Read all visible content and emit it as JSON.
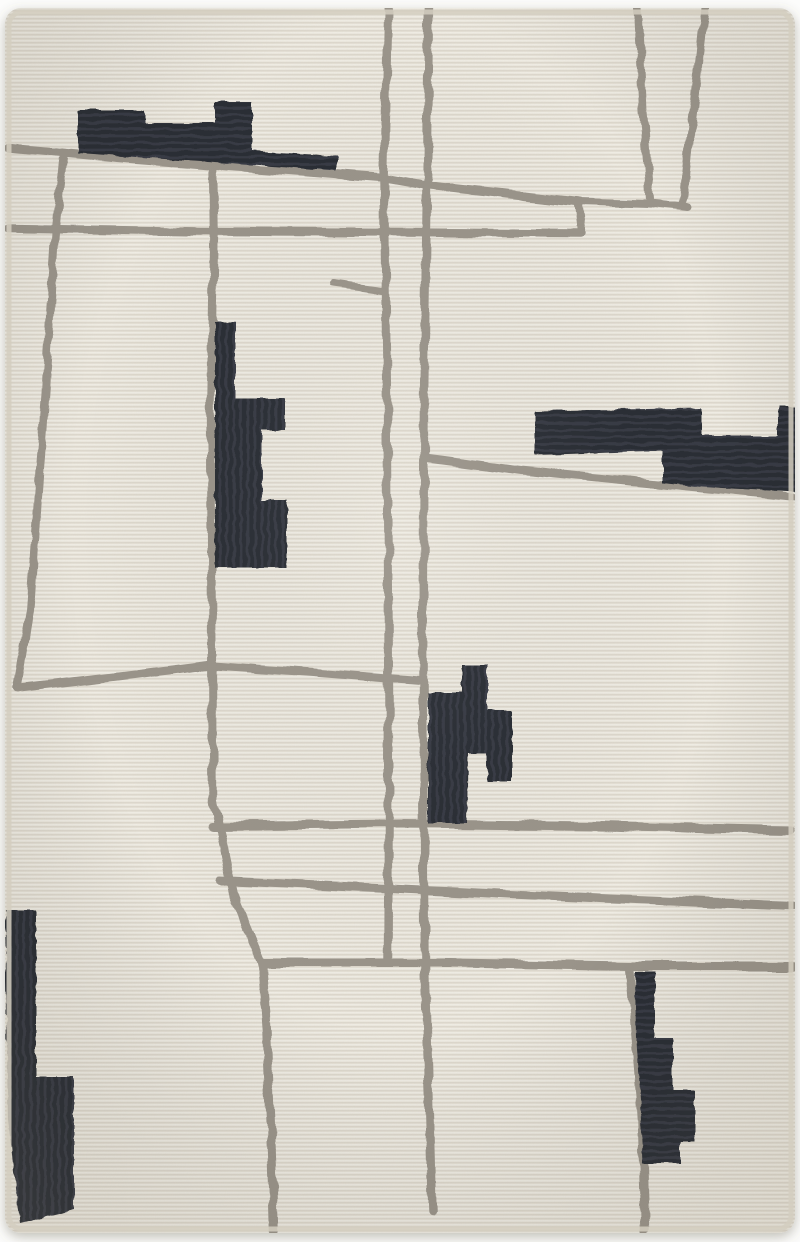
{
  "image": {
    "subject": "Abstract modern area rug, ivory wool with taupe gray abstract map lines and dark charcoal geometric tetris-like blocks",
    "canvas": {
      "width": 800,
      "height": 1242
    },
    "colors": {
      "background": "#fcfcfb",
      "rug_base": "#e9e5da",
      "weave_light": "rgba(255,255,255,0.30)",
      "weave_dark": "rgba(120,110,92,0.13)",
      "rug_edge": "#d4cec0",
      "line_gray": "#9a948a",
      "block_black": "#2b2d34",
      "block_rib": "#383b44",
      "shadow": "rgba(95,88,72,0.38)",
      "vignette": "rgba(125,115,94,0.14)"
    },
    "rug": {
      "x": 5,
      "y": 8,
      "width": 790,
      "height": 1225,
      "corner_radius": 16,
      "binding_inset": 4,
      "binding_width": 5
    },
    "lines": [
      {
        "name": "line-top-diagonal",
        "width": 8.5,
        "points": [
          [
            10,
            148
          ],
          [
            120,
            158
          ],
          [
            240,
            167
          ],
          [
            383,
            178
          ],
          [
            428,
            186
          ],
          [
            577,
            202
          ]
        ]
      },
      {
        "name": "line-top-diagonal-right",
        "width": 8,
        "points": [
          [
            577,
            202
          ],
          [
            650,
            204
          ],
          [
            690,
            208
          ]
        ]
      },
      {
        "name": "line-step-drop",
        "width": 8,
        "points": [
          [
            577,
            202
          ],
          [
            581,
            232
          ]
        ]
      },
      {
        "name": "line-upper-horizontal",
        "width": 8.5,
        "points": [
          [
            8,
            228
          ],
          [
            200,
            231
          ],
          [
            400,
            232
          ],
          [
            581,
            233
          ]
        ]
      },
      {
        "name": "line-left-vertical",
        "width": 8,
        "points": [
          [
            64,
            153
          ],
          [
            55,
            232
          ],
          [
            45,
            400
          ],
          [
            30,
            610
          ],
          [
            17,
            688
          ]
        ]
      },
      {
        "name": "line-mid-left-horizontal",
        "width": 8.5,
        "points": [
          [
            17,
            688
          ],
          [
            120,
            676
          ],
          [
            210,
            665
          ],
          [
            310,
            672
          ],
          [
            423,
            681
          ]
        ]
      },
      {
        "name": "line-center-vertical",
        "width": 8.5,
        "points": [
          [
            213,
            164
          ],
          [
            214,
            232
          ],
          [
            211,
            400
          ],
          [
            212,
            600
          ],
          [
            213,
            797
          ],
          [
            233,
            893
          ],
          [
            262,
            963
          ]
        ]
      },
      {
        "name": "line-center-vertical-low",
        "width": 8.5,
        "points": [
          [
            262,
            963
          ],
          [
            267,
            1033
          ],
          [
            271,
            1130
          ],
          [
            274,
            1230
          ]
        ]
      },
      {
        "name": "line-road-vertical-a",
        "width": 8.5,
        "points": [
          [
            388,
            0
          ],
          [
            384,
            180
          ],
          [
            387,
            400
          ],
          [
            389,
            700
          ],
          [
            388,
            963
          ]
        ]
      },
      {
        "name": "line-road-vertical-b",
        "width": 8.5,
        "points": [
          [
            429,
            0
          ],
          [
            427,
            186
          ],
          [
            424,
            400
          ],
          [
            423,
            683
          ],
          [
            425,
            967
          ],
          [
            429,
            1100
          ],
          [
            432,
            1213
          ]
        ]
      },
      {
        "name": "line-funnel-left",
        "width": 8,
        "points": [
          [
            638,
            8
          ],
          [
            643,
            110
          ],
          [
            650,
            200
          ]
        ]
      },
      {
        "name": "line-funnel-right",
        "width": 8,
        "points": [
          [
            705,
            8
          ],
          [
            688,
            150
          ],
          [
            683,
            206
          ]
        ]
      },
      {
        "name": "line-short-stub",
        "width": 7,
        "points": [
          [
            333,
            284
          ],
          [
            385,
            291
          ]
        ]
      },
      {
        "name": "line-right-diagonal",
        "width": 8,
        "points": [
          [
            428,
            458
          ],
          [
            520,
            470
          ],
          [
            653,
            483
          ],
          [
            797,
            497
          ]
        ]
      },
      {
        "name": "line-lower-horizontal-1",
        "width": 9,
        "points": [
          [
            212,
            826
          ],
          [
            400,
            824
          ],
          [
            600,
            826
          ],
          [
            790,
            830
          ]
        ]
      },
      {
        "name": "line-lower-horizontal-2",
        "width": 9,
        "points": [
          [
            220,
            881
          ],
          [
            400,
            889
          ],
          [
            600,
            898
          ],
          [
            792,
            906
          ]
        ]
      },
      {
        "name": "line-lower-horizontal-3",
        "width": 9,
        "points": [
          [
            262,
            963
          ],
          [
            450,
            963
          ],
          [
            630,
            966
          ],
          [
            793,
            966
          ]
        ]
      },
      {
        "name": "line-bottom-vertical",
        "width": 8.5,
        "points": [
          [
            630,
            967
          ],
          [
            636,
            1040
          ],
          [
            642,
            1120
          ],
          [
            645,
            1230
          ]
        ]
      }
    ],
    "blocks": [
      {
        "name": "block-top-left-skyline",
        "ribs": "h",
        "points": [
          [
            78,
            110
          ],
          [
            145,
            110
          ],
          [
            145,
            123
          ],
          [
            215,
            123
          ],
          [
            215,
            102
          ],
          [
            252,
            102
          ],
          [
            252,
            151
          ],
          [
            337,
            156
          ],
          [
            337,
            171
          ],
          [
            78,
            153
          ]
        ]
      },
      {
        "name": "block-left-middle",
        "ribs": "v",
        "points": [
          [
            215,
            322
          ],
          [
            235,
            322
          ],
          [
            235,
            398
          ],
          [
            285,
            398
          ],
          [
            285,
            430
          ],
          [
            262,
            430
          ],
          [
            262,
            500
          ],
          [
            287,
            500
          ],
          [
            287,
            568
          ],
          [
            215,
            568
          ]
        ]
      },
      {
        "name": "block-right-bars",
        "ribs": "h",
        "points": [
          [
            535,
            411
          ],
          [
            702,
            408
          ],
          [
            702,
            436
          ],
          [
            778,
            436
          ],
          [
            778,
            406
          ],
          [
            797,
            406
          ],
          [
            798,
            492
          ],
          [
            702,
            487
          ],
          [
            663,
            483
          ],
          [
            663,
            451
          ],
          [
            535,
            455
          ]
        ]
      },
      {
        "name": "block-center-tetris",
        "ribs": "v",
        "points": [
          [
            462,
            665
          ],
          [
            487,
            665
          ],
          [
            487,
            710
          ],
          [
            512,
            710
          ],
          [
            512,
            782
          ],
          [
            487,
            782
          ],
          [
            487,
            753
          ],
          [
            468,
            753
          ],
          [
            467,
            823
          ],
          [
            428,
            823
          ],
          [
            428,
            693
          ],
          [
            462,
            693
          ]
        ]
      },
      {
        "name": "block-bottom-left",
        "ribs": "v",
        "points": [
          [
            5,
            910
          ],
          [
            36,
            910
          ],
          [
            36,
            1077
          ],
          [
            74,
            1077
          ],
          [
            74,
            1210
          ],
          [
            20,
            1223
          ],
          [
            8,
            1120
          ]
        ]
      },
      {
        "name": "block-bottom-stairs",
        "ribs": "h",
        "points": [
          [
            635,
            972
          ],
          [
            655,
            972
          ],
          [
            655,
            1038
          ],
          [
            673,
            1038
          ],
          [
            673,
            1090
          ],
          [
            695,
            1090
          ],
          [
            695,
            1142
          ],
          [
            680,
            1142
          ],
          [
            680,
            1163
          ],
          [
            643,
            1163
          ],
          [
            640,
            1100
          ],
          [
            636,
            1040
          ]
        ]
      }
    ]
  }
}
